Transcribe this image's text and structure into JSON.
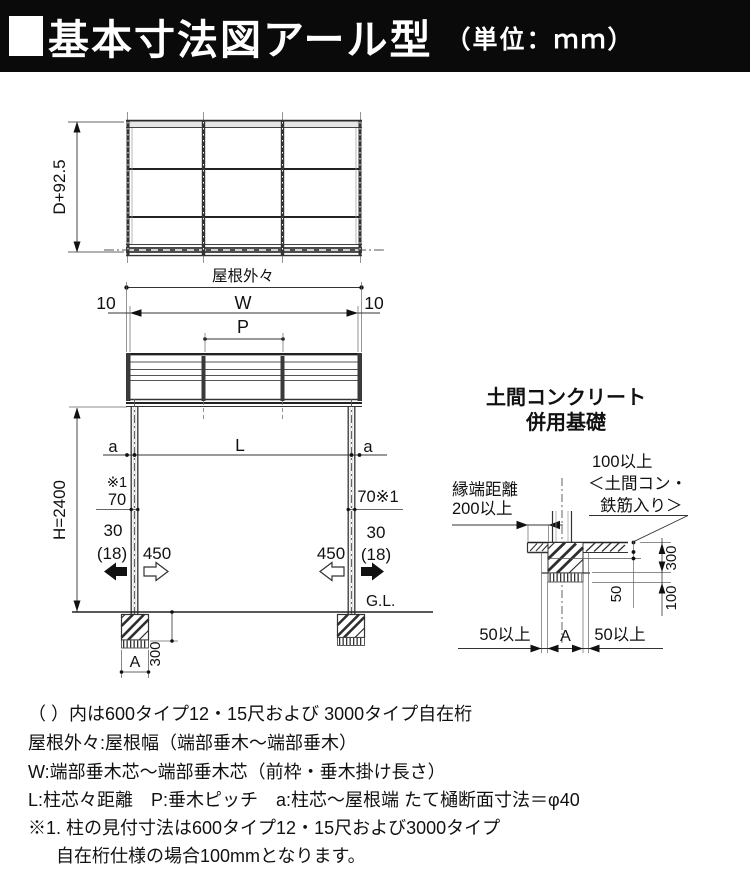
{
  "header": {
    "title": "基本寸法図アール型",
    "unit": "（単位：ｍｍ）"
  },
  "top_view": {
    "depth_dim": "D+92.5",
    "outer_width_label": "屋根外々"
  },
  "front_view": {
    "edge_offset": "10",
    "width_label": "W",
    "pitch_label": "P",
    "a_label": "a",
    "span_label": "L",
    "note_ref": "※1",
    "post_width": "70",
    "post_width_right": "70※1",
    "clearance_30": "30",
    "clearance_18": "(18)",
    "clearance_450": "450",
    "height_label": "H=2400",
    "ground_label": "G.L.",
    "footing_depth": "300",
    "footing_width_label": "A"
  },
  "detail": {
    "title_line1": "土間コンクリート",
    "title_line2": "併用基礎",
    "edge_distance_line1": "縁端距離",
    "edge_distance_line2": "200以上",
    "slab_note_line1": "100以上",
    "slab_note_line2": "＜土間コン・",
    "slab_note_line3": "鉄筋入り＞",
    "depth_300": "300",
    "slab_100": "100",
    "gap_50": "50",
    "min_50": "50以上",
    "footing_width_label": "A"
  },
  "notes": {
    "lines": [
      "（ ）内は600タイプ12・15尺および 3000タイプ自在桁",
      "屋根外々:屋根幅（端部垂木〜端部垂木）",
      "W:端部垂木芯〜端部垂木芯（前枠・垂木掛け長さ）",
      "L:柱芯々距離　P:垂木ピッチ　a:柱芯〜屋根端 たて樋断面寸法＝φ40",
      "※1. 柱の見付寸法は600タイプ12・15尺および3000タイプ",
      "自在桁仕様の場合100mmとなります。"
    ]
  }
}
